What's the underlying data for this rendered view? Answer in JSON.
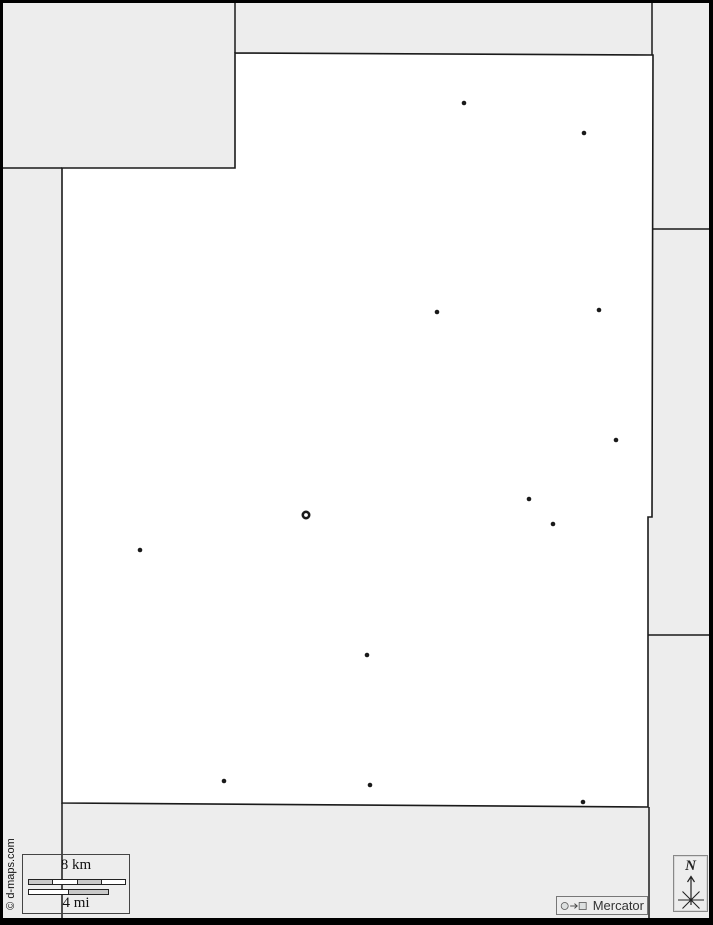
{
  "canvas": {
    "bg": "#ededed",
    "map_fill": "#ffffff",
    "stroke": "#1a1a1a",
    "frame": "#000000"
  },
  "map": {
    "region_polygon": [
      [
        235,
        53
      ],
      [
        653,
        55
      ],
      [
        652,
        517
      ],
      [
        648,
        517
      ],
      [
        648,
        807
      ],
      [
        62,
        803
      ],
      [
        62,
        168
      ],
      [
        235,
        168
      ]
    ],
    "neighbor_borders": [
      [
        [
          235,
          0
        ],
        [
          235,
          53
        ]
      ],
      [
        [
          0,
          168
        ],
        [
          62,
          168
        ]
      ],
      [
        [
          62,
          803
        ],
        [
          62,
          923
        ]
      ],
      [
        [
          652,
          0
        ],
        [
          652,
          55
        ]
      ],
      [
        [
          649,
          807
        ],
        [
          649,
          923
        ]
      ],
      [
        [
          652,
          229
        ],
        [
          713,
          229
        ]
      ],
      [
        [
          648,
          635
        ],
        [
          713,
          635
        ]
      ]
    ],
    "city_dots": [
      {
        "x": 464,
        "y": 103
      },
      {
        "x": 584,
        "y": 133
      },
      {
        "x": 437,
        "y": 312
      },
      {
        "x": 599,
        "y": 310
      },
      {
        "x": 616,
        "y": 440
      },
      {
        "x": 529,
        "y": 499
      },
      {
        "x": 553,
        "y": 524
      },
      {
        "x": 140,
        "y": 550
      },
      {
        "x": 367,
        "y": 655
      },
      {
        "x": 224,
        "y": 781
      },
      {
        "x": 370,
        "y": 785
      },
      {
        "x": 583,
        "y": 802
      }
    ],
    "capital_ring": {
      "x": 306,
      "y": 515
    },
    "dot_radius": 2.3,
    "ring": {
      "r": 3.2,
      "stroke_width": 2.6
    }
  },
  "scale": {
    "km_label": "8 km",
    "mi_label": "4 mi",
    "km_segments": [
      "#c8c8c8",
      "#ffffff",
      "#c8c8c8",
      "#ffffff"
    ],
    "mi_segments": [
      "#ffffff",
      "#c8c8c8"
    ]
  },
  "annotations": {
    "copyright": "© d-maps.com",
    "projection_label": "Mercator",
    "north_label": "N"
  }
}
